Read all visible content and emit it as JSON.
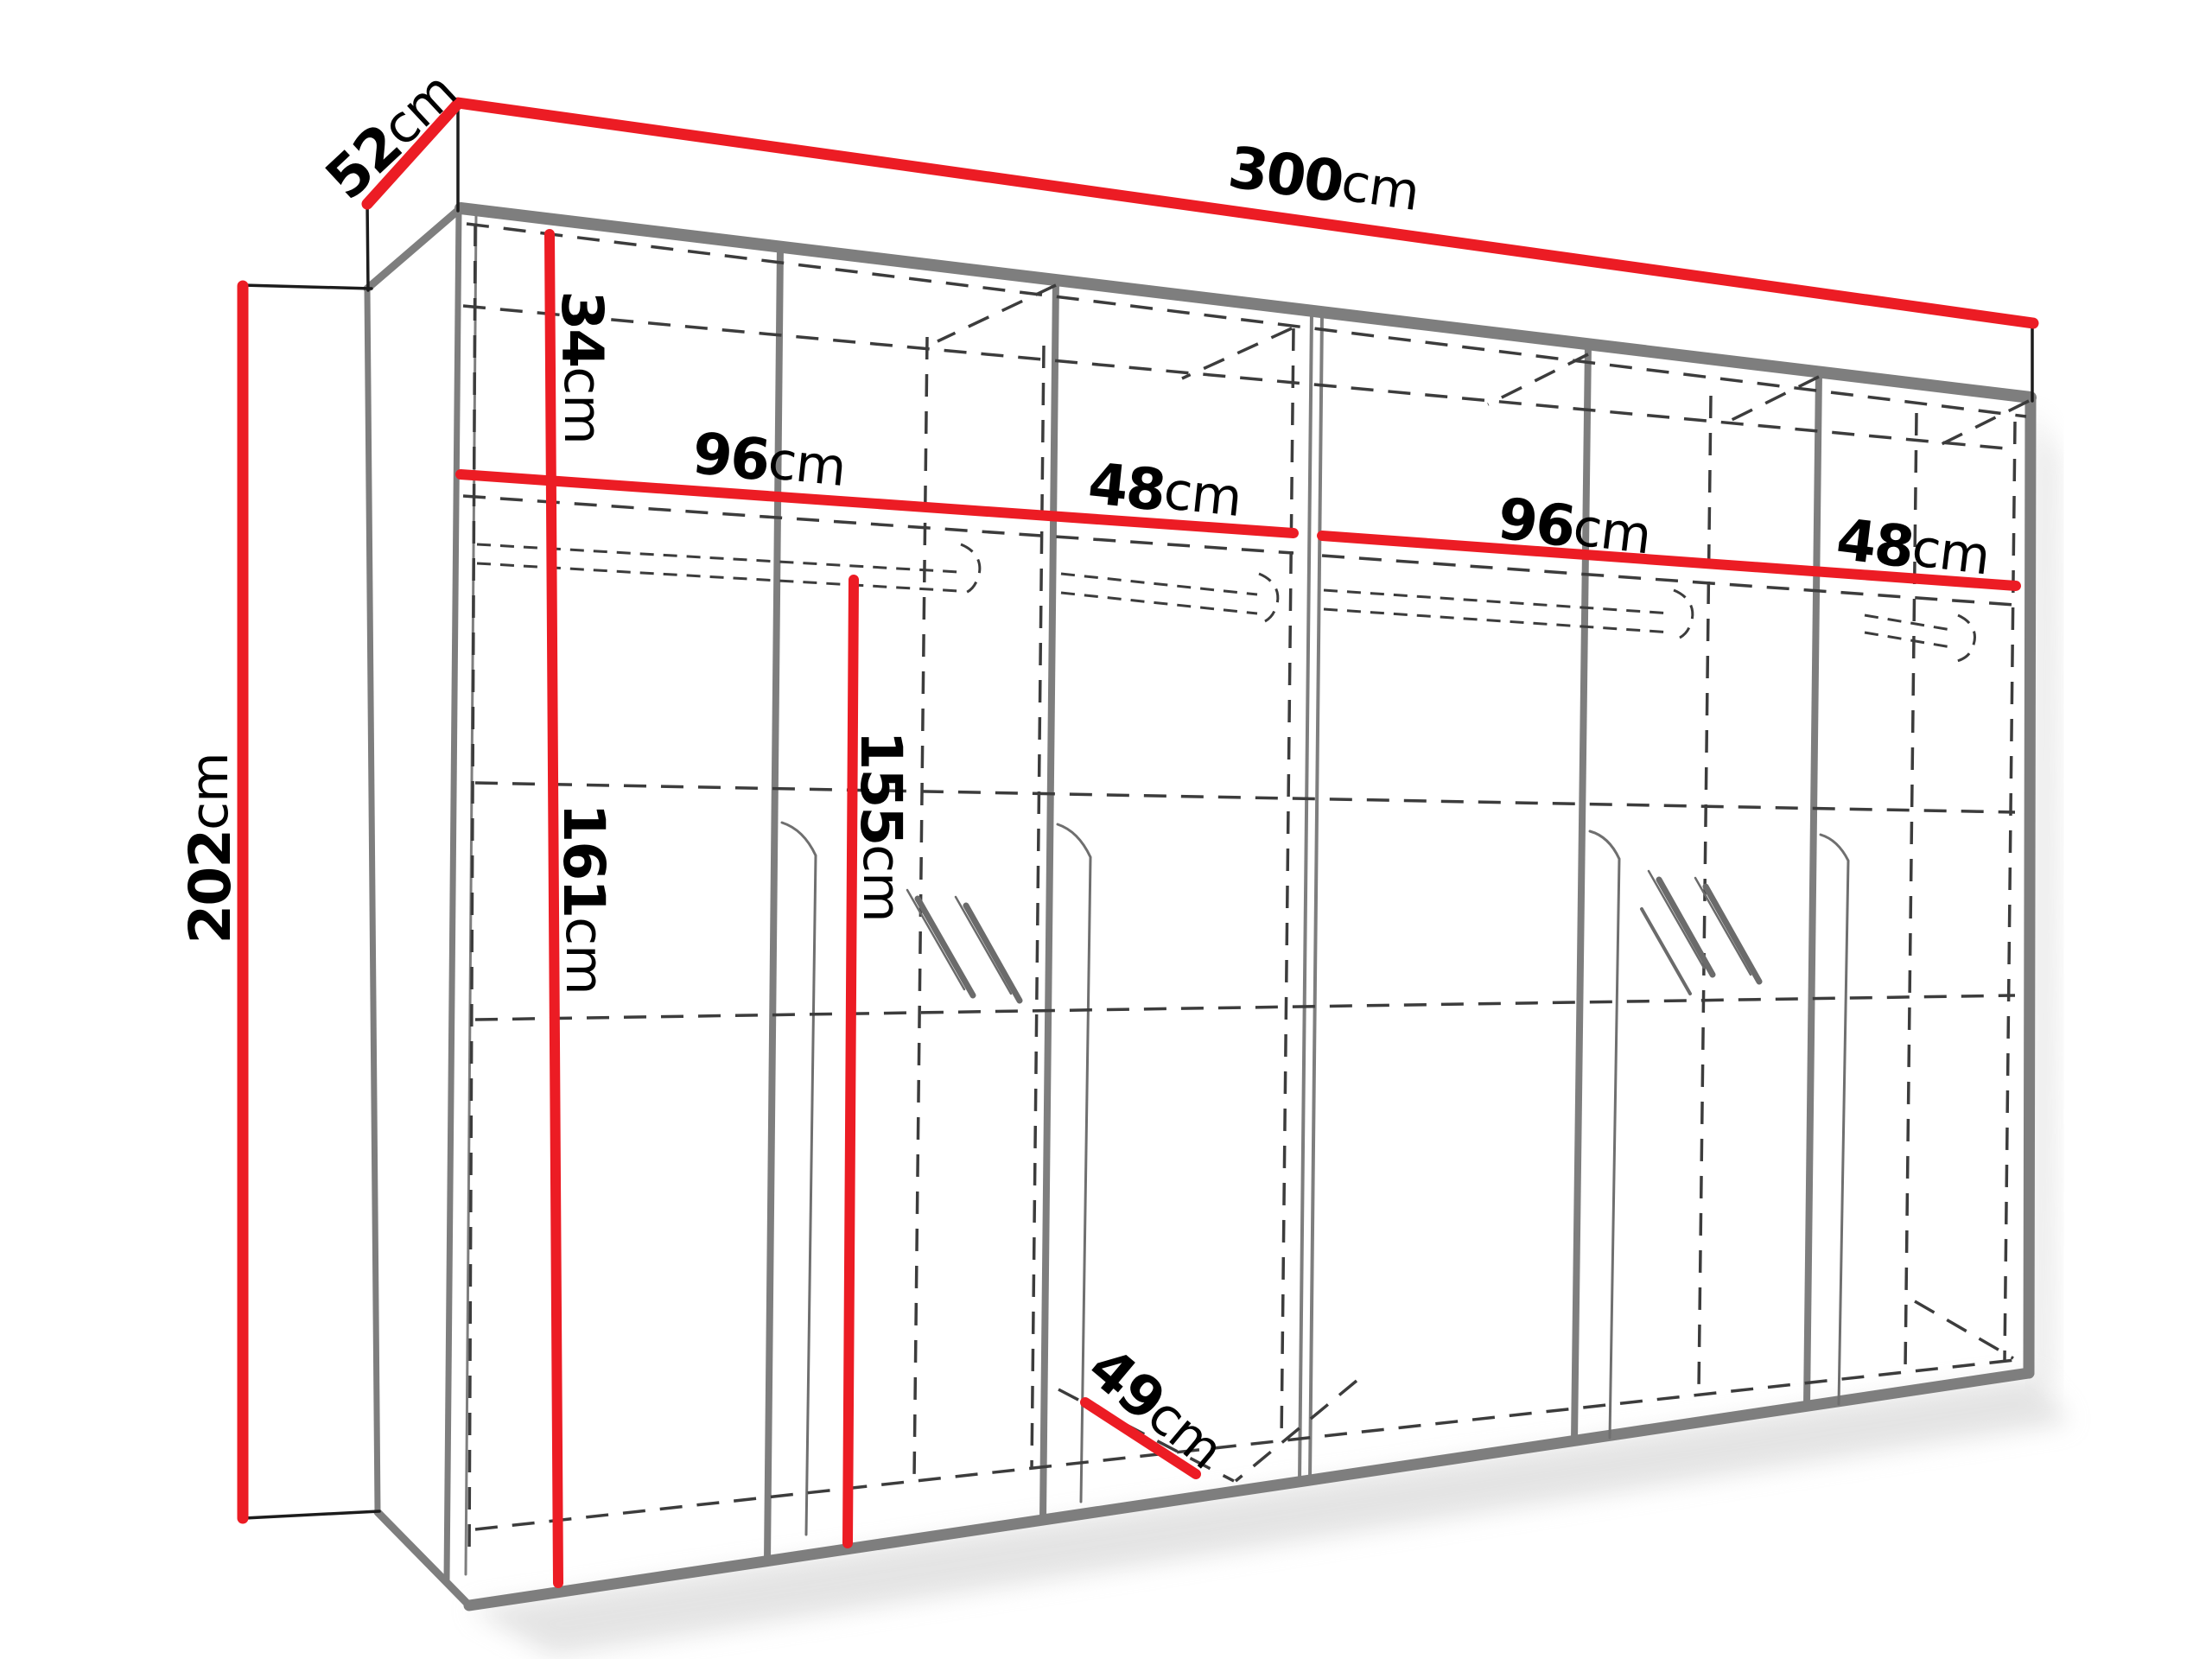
{
  "diagram": {
    "title": "Wardrobe dimension diagram",
    "object": "six-door wardrobe with two mirror doors, perspective line drawing with internal shelves and clothes rails shown dashed",
    "background": "#ffffff",
    "colors": {
      "dimension_line": "#ec1c24",
      "structure": "#7e7e7e",
      "hidden_line": "#3c3c3c",
      "label_text": "#000000"
    },
    "labels": {
      "width": {
        "value": "300",
        "unit": "cm"
      },
      "depth": {
        "value": "52",
        "unit": "cm"
      },
      "height": {
        "value": "202",
        "unit": "cm"
      },
      "top_shelf": {
        "value": "34",
        "unit": "cm"
      },
      "section1": {
        "value": "96",
        "unit": "cm"
      },
      "section2": {
        "value": "48",
        "unit": "cm"
      },
      "section3": {
        "value": "96",
        "unit": "cm"
      },
      "section4": {
        "value": "48",
        "unit": "cm"
      },
      "hanging_left": {
        "value": "161",
        "unit": "cm"
      },
      "hanging_mid": {
        "value": "155",
        "unit": "cm"
      },
      "interior_depth": {
        "value": "49",
        "unit": "cm"
      }
    }
  }
}
